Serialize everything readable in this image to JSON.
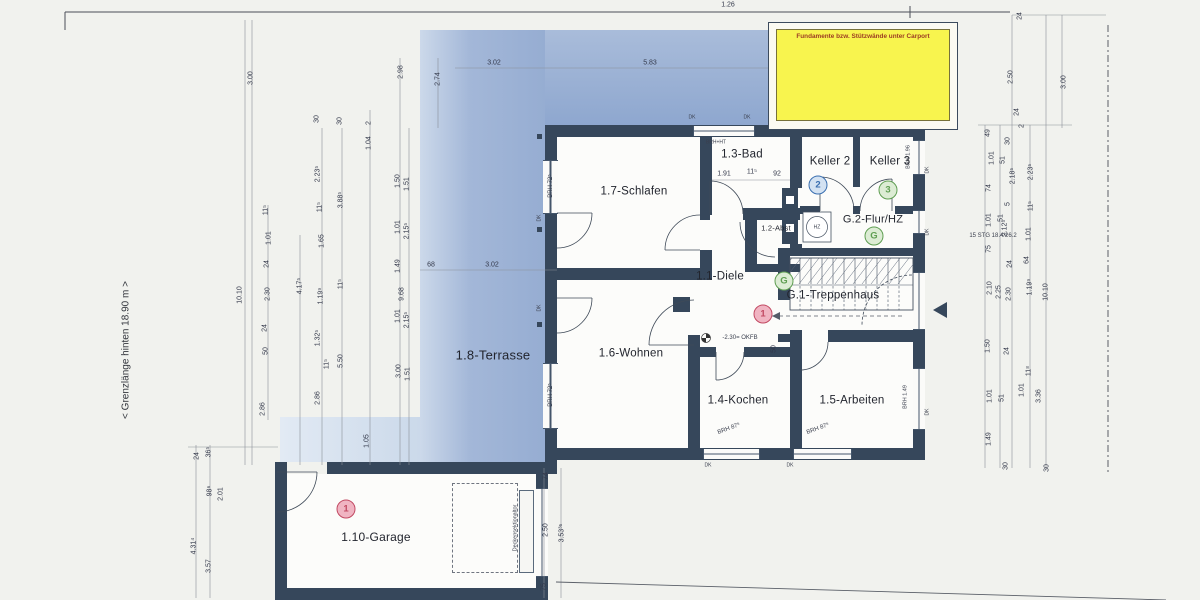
{
  "texts": {
    "boundary_left": "< Grenzlänge hinten 18.90 m >",
    "carport_note": "Fundamente bzw. Stützwände unter Carport"
  },
  "colors": {
    "wall": "#36475b",
    "terrace": "#9fb4d7",
    "terrace_light": "#cfdcee",
    "carport_note_bg": "#f8f44e",
    "carport_note_text": "#9c3b22",
    "marker_blue": "#3a6fb0",
    "marker_green": "#5f9e52",
    "marker_red": "#c24a63"
  },
  "rooms": [
    {
      "id": "schlafen",
      "label": "1.7-Schlafen",
      "x": 634,
      "y": 192
    },
    {
      "id": "bad",
      "label": "1.3-Bad",
      "x": 742,
      "y": 155
    },
    {
      "id": "keller2",
      "label": "Keller 2",
      "x": 830,
      "y": 162
    },
    {
      "id": "keller3",
      "label": "Keller 3",
      "x": 890,
      "y": 162
    },
    {
      "id": "flur-hz",
      "label": "G.2-Flur/HZ",
      "x": 873,
      "y": 220,
      "s": 11
    },
    {
      "id": "abst",
      "label": "1.2-Abst",
      "x": 776,
      "y": 228,
      "s": 7.5
    },
    {
      "id": "diele",
      "label": "1.1-Diele",
      "x": 720,
      "y": 277
    },
    {
      "id": "treppenhaus",
      "label": "G.1-Treppenhaus",
      "x": 833,
      "y": 296
    },
    {
      "id": "wohnen",
      "label": "1.6-Wohnen",
      "x": 631,
      "y": 354
    },
    {
      "id": "kochen",
      "label": "1.4-Kochen",
      "x": 738,
      "y": 401
    },
    {
      "id": "arbeiten",
      "label": "1.5-Arbeiten",
      "x": 852,
      "y": 401
    },
    {
      "id": "terrasse",
      "label": "1.8-Terrasse",
      "x": 493,
      "y": 355,
      "s": 13
    },
    {
      "id": "garage",
      "label": "1.10-Garage",
      "x": 376,
      "y": 537,
      "s": 12
    }
  ],
  "markers": [
    {
      "label": "2",
      "color": "blue",
      "x": 818,
      "y": 185
    },
    {
      "label": "3",
      "color": "green",
      "x": 888,
      "y": 190
    },
    {
      "label": "G",
      "color": "green",
      "x": 874,
      "y": 236
    },
    {
      "label": "G",
      "color": "green",
      "x": 784,
      "y": 281
    },
    {
      "label": "1",
      "color": "red",
      "x": 763,
      "y": 314
    },
    {
      "label": "1",
      "color": "red",
      "x": 346,
      "y": 509
    }
  ],
  "small_labels": [
    {
      "t": "BRH 72⁵",
      "x": 551,
      "y": 186,
      "r": -90,
      "s": 6
    },
    {
      "t": "BRH 72⁵",
      "x": 551,
      "y": 395,
      "r": -90,
      "s": 6
    },
    {
      "t": "BRH 1.96",
      "x": 909,
      "y": 157,
      "r": -90,
      "s": 5.5
    },
    {
      "t": "BRH 1.49",
      "x": 906,
      "y": 397,
      "r": -90,
      "s": 5.5
    },
    {
      "t": "BRH 87⁵",
      "x": 729,
      "y": 429,
      "r": -20,
      "s": 6
    },
    {
      "t": "BRH 87⁵",
      "x": 818,
      "y": 429,
      "r": -20,
      "s": 6
    },
    {
      "t": "BRH+HT",
      "x": 716,
      "y": 143,
      "r": 0,
      "s": 5
    },
    {
      "t": "DK",
      "x": 692,
      "y": 118,
      "r": 0,
      "s": 5
    },
    {
      "t": "DK",
      "x": 747,
      "y": 118,
      "r": 0,
      "s": 5
    },
    {
      "t": "DK",
      "x": 928,
      "y": 170,
      "r": -90,
      "s": 5
    },
    {
      "t": "DK",
      "x": 928,
      "y": 232,
      "r": -90,
      "s": 5
    },
    {
      "t": "DK",
      "x": 928,
      "y": 412,
      "r": -90,
      "s": 5
    },
    {
      "t": "DK",
      "x": 708,
      "y": 466,
      "r": 0,
      "s": 5
    },
    {
      "t": "DK",
      "x": 790,
      "y": 466,
      "r": 0,
      "s": 5
    },
    {
      "t": "DK",
      "x": 540,
      "y": 218,
      "r": -90,
      "s": 5
    },
    {
      "t": "DK",
      "x": 540,
      "y": 308,
      "r": -90,
      "s": 5
    },
    {
      "t": "Deckensektionaltor",
      "x": 516,
      "y": 528,
      "r": -90,
      "s": 5.5
    },
    {
      "t": "HZ",
      "x": 817,
      "y": 228,
      "r": 0,
      "s": 5
    },
    {
      "t": "-2.30= OKFB",
      "x": 740,
      "y": 338,
      "r": 0,
      "s": 6
    },
    {
      "t": "15 STG 18.4/26.2",
      "x": 993,
      "y": 236,
      "r": 0,
      "s": 6
    }
  ],
  "dimensions": [
    {
      "t": "1.26",
      "x": 728,
      "y": 5,
      "r": 0
    },
    {
      "t": "3.00",
      "x": 251,
      "y": 78
    },
    {
      "t": "2.98",
      "x": 401,
      "y": 72
    },
    {
      "t": "2.74",
      "x": 438,
      "y": 79
    },
    {
      "t": "3.02",
      "x": 494,
      "y": 63,
      "r": 0
    },
    {
      "t": "5.83",
      "x": 650,
      "y": 63,
      "r": 0
    },
    {
      "t": "30",
      "x": 317,
      "y": 119
    },
    {
      "t": "30",
      "x": 340,
      "y": 121
    },
    {
      "t": "2",
      "x": 369,
      "y": 123
    },
    {
      "t": "1.04",
      "x": 369,
      "y": 143
    },
    {
      "t": "2.23⁵",
      "x": 318,
      "y": 174
    },
    {
      "t": "11⁵",
      "x": 320,
      "y": 207
    },
    {
      "t": "3.88⁵",
      "x": 341,
      "y": 200
    },
    {
      "t": "1.50",
      "x": 398,
      "y": 181
    },
    {
      "t": "1.51",
      "x": 407,
      "y": 184
    },
    {
      "t": "1.01",
      "x": 398,
      "y": 227
    },
    {
      "t": "2.15⁵",
      "x": 407,
      "y": 231
    },
    {
      "t": "1.65",
      "x": 322,
      "y": 241
    },
    {
      "t": "11⁵",
      "x": 341,
      "y": 284
    },
    {
      "t": "1.49",
      "x": 398,
      "y": 266
    },
    {
      "t": "4.17⁵",
      "x": 300,
      "y": 286
    },
    {
      "t": "1.19⁹",
      "x": 321,
      "y": 296
    },
    {
      "t": "9.68",
      "x": 402,
      "y": 294
    },
    {
      "t": "1.32⁵",
      "x": 318,
      "y": 338
    },
    {
      "t": "1.01",
      "x": 398,
      "y": 316
    },
    {
      "t": "2.15⁵",
      "x": 407,
      "y": 320
    },
    {
      "t": "5.50",
      "x": 341,
      "y": 361
    },
    {
      "t": "11⁵",
      "x": 327,
      "y": 364
    },
    {
      "t": "3.00",
      "x": 399,
      "y": 371
    },
    {
      "t": "1.51",
      "x": 408,
      "y": 374
    },
    {
      "t": "2.86",
      "x": 318,
      "y": 398
    },
    {
      "t": "1.05",
      "x": 367,
      "y": 441
    },
    {
      "t": "68",
      "x": 431,
      "y": 265,
      "r": 0
    },
    {
      "t": "3.02",
      "x": 492,
      "y": 265,
      "r": 0
    },
    {
      "t": "10.10",
      "x": 240,
      "y": 295
    },
    {
      "t": "2.30",
      "x": 268,
      "y": 294
    },
    {
      "t": "24",
      "x": 267,
      "y": 264
    },
    {
      "t": "1.01",
      "x": 269,
      "y": 238
    },
    {
      "t": "11⁵",
      "x": 266,
      "y": 210
    },
    {
      "t": "50",
      "x": 266,
      "y": 351
    },
    {
      "t": "24",
      "x": 265,
      "y": 328
    },
    {
      "t": "2.86",
      "x": 263,
      "y": 409
    },
    {
      "t": "24",
      "x": 197,
      "y": 456
    },
    {
      "t": "36⁵",
      "x": 209,
      "y": 452
    },
    {
      "t": "98⁶",
      "x": 210,
      "y": 491
    },
    {
      "t": "2.01",
      "x": 221,
      "y": 494
    },
    {
      "t": "4.31⁴",
      "x": 194,
      "y": 546
    },
    {
      "t": "3.57",
      "x": 209,
      "y": 566
    },
    {
      "t": "74",
      "x": 546,
      "y": 476
    },
    {
      "t": "2.50",
      "x": 546,
      "y": 530
    },
    {
      "t": "3.53³⁵",
      "x": 562,
      "y": 533
    },
    {
      "t": "75",
      "x": 544,
      "y": 587
    },
    {
      "t": "1.91",
      "x": 724,
      "y": 174,
      "r": 0
    },
    {
      "t": "11⁵",
      "x": 752,
      "y": 172,
      "r": 0
    },
    {
      "t": "92",
      "x": 777,
      "y": 174,
      "r": 0
    },
    {
      "t": "50",
      "x": 774,
      "y": 349
    },
    {
      "t": "49",
      "x": 988,
      "y": 133
    },
    {
      "t": "30",
      "x": 1008,
      "y": 141
    },
    {
      "t": "1.01",
      "x": 992,
      "y": 158
    },
    {
      "t": "51",
      "x": 1003,
      "y": 160
    },
    {
      "t": "2.18⁵",
      "x": 1013,
      "y": 176
    },
    {
      "t": "2.23⁵",
      "x": 1031,
      "y": 172
    },
    {
      "t": "74",
      "x": 989,
      "y": 188
    },
    {
      "t": "5",
      "x": 1008,
      "y": 204
    },
    {
      "t": "11⁵",
      "x": 1031,
      "y": 206
    },
    {
      "t": "1.01",
      "x": 989,
      "y": 220
    },
    {
      "t": "51",
      "x": 1001,
      "y": 218
    },
    {
      "t": "2.12⁵",
      "x": 1005,
      "y": 228
    },
    {
      "t": "1.01",
      "x": 1029,
      "y": 234
    },
    {
      "t": "75",
      "x": 989,
      "y": 249
    },
    {
      "t": "24",
      "x": 1010,
      "y": 264
    },
    {
      "t": "64",
      "x": 1027,
      "y": 260
    },
    {
      "t": "2.10",
      "x": 990,
      "y": 288
    },
    {
      "t": "2.25",
      "x": 999,
      "y": 292
    },
    {
      "t": "2.30",
      "x": 1009,
      "y": 294
    },
    {
      "t": "1.19⁹",
      "x": 1030,
      "y": 287
    },
    {
      "t": "10.10",
      "x": 1046,
      "y": 292
    },
    {
      "t": "1.50",
      "x": 988,
      "y": 346
    },
    {
      "t": "24",
      "x": 1007,
      "y": 351
    },
    {
      "t": "1.01",
      "x": 990,
      "y": 396
    },
    {
      "t": "51",
      "x": 1002,
      "y": 398
    },
    {
      "t": "11⁸",
      "x": 1029,
      "y": 371
    },
    {
      "t": "1.01",
      "x": 1022,
      "y": 390
    },
    {
      "t": "3.36",
      "x": 1039,
      "y": 396
    },
    {
      "t": "1.49",
      "x": 989,
      "y": 439
    },
    {
      "t": "30",
      "x": 1006,
      "y": 466
    },
    {
      "t": "30",
      "x": 1047,
      "y": 468
    },
    {
      "t": "24",
      "x": 1020,
      "y": 16
    },
    {
      "t": "2.50",
      "x": 1011,
      "y": 77
    },
    {
      "t": "3.00",
      "x": 1064,
      "y": 82
    },
    {
      "t": "24",
      "x": 1017,
      "y": 112
    },
    {
      "t": "2",
      "x": 1022,
      "y": 126
    }
  ]
}
